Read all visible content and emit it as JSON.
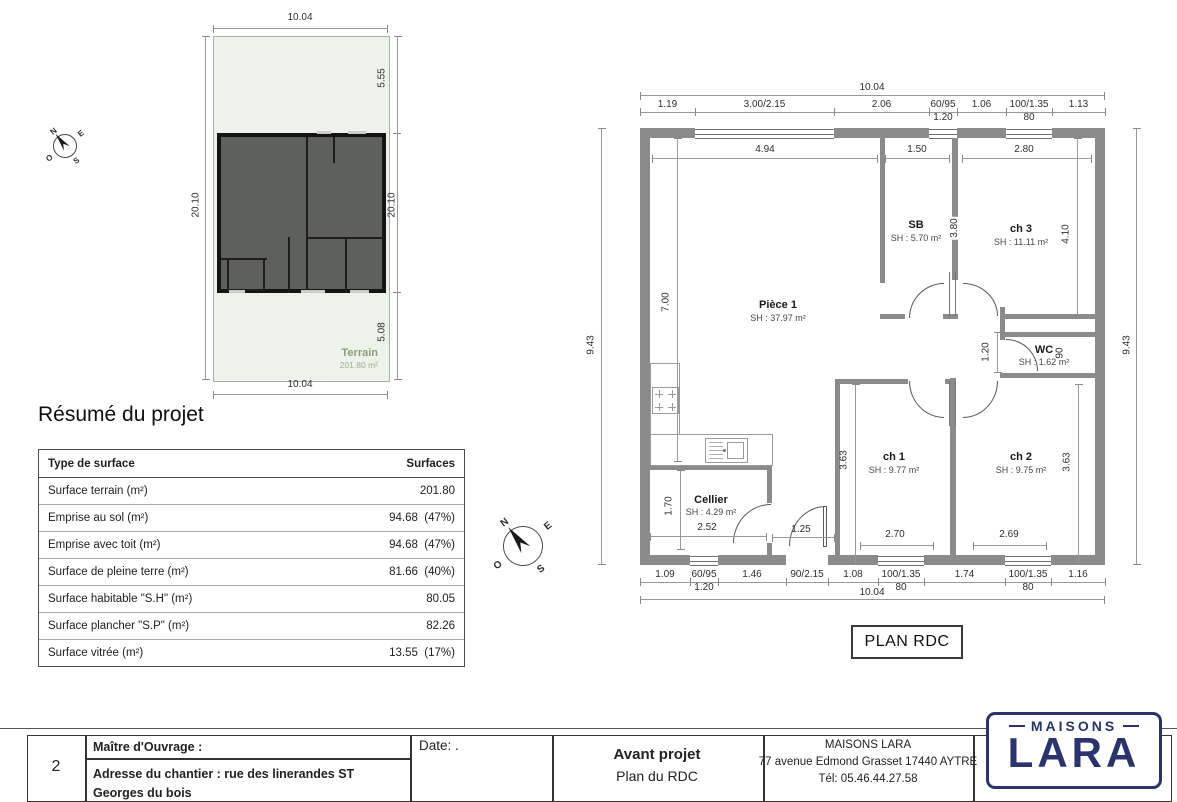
{
  "colors": {
    "wall_gray": "#8b8b8b",
    "terrain_fill": "#edf2eb",
    "terrain_text_green": "#87a176",
    "building_fill": "#5e605c",
    "logo_navy": "#29336e"
  },
  "compass": {
    "n": "N",
    "e": "E",
    "s": "S",
    "o": "O"
  },
  "site_plan": {
    "dim_width_top": "10.04",
    "dim_width_bottom": "10.04",
    "dim_depth_left": "20.10",
    "dim_depth_right": "20.10",
    "dim_front": "5.55",
    "dim_rear": "5.08",
    "terrain_label": "Terrain",
    "terrain_area": "201.80 m²"
  },
  "summary": {
    "title": "Résumé du projet",
    "col_type": "Type de surface",
    "col_value": "Surfaces",
    "rows": [
      {
        "label": "Surface terrain (m²)",
        "value": "201.80"
      },
      {
        "label": "Emprise au sol (m²)",
        "value": "94.68  (47%)"
      },
      {
        "label": "Emprise avec toit (m²)",
        "value": "94.68  (47%)"
      },
      {
        "label": "Surface de pleine terre (m²)",
        "value": "81.66  (40%)"
      },
      {
        "label": "Surface habitable \"S.H\" (m²)",
        "value": "80.05"
      },
      {
        "label": "Surface plancher \"S.P\" (m²)",
        "value": "82.26"
      },
      {
        "label": "Surface vitrée (m²)",
        "value": "13.55  (17%)"
      }
    ]
  },
  "floor_plan": {
    "caption": "PLAN RDC",
    "dim_overall_top": "10.04",
    "dim_overall_bottom": "10.04",
    "dim_height_left": "9.43",
    "dim_height_right": "9.43",
    "top_chain": [
      "1.19",
      "3.00/2.15",
      "2.06",
      "60/95",
      "1.06",
      "100/1.35",
      "1.13"
    ],
    "top_chain_sub": [
      "",
      "",
      "",
      "1.20",
      "",
      "80",
      ""
    ],
    "bottom_chain": [
      "1.09",
      "60/95",
      "1.46",
      "90/2.15",
      "1.08",
      "100/1.35",
      "1.74",
      "100/1.35",
      "1.16"
    ],
    "bottom_chain_sub": [
      "",
      "1.20",
      "",
      "",
      "",
      "80",
      "",
      "80",
      ""
    ],
    "rooms": {
      "piece1": {
        "name": "Pièce 1",
        "area": "SH : 37.97 m²"
      },
      "sb": {
        "name": "SB",
        "area": "SH : 5.70 m²"
      },
      "ch3": {
        "name": "ch 3",
        "area": "SH : 11.11 m²"
      },
      "wc": {
        "name": "WC",
        "area": "SH : 1.62 m²"
      },
      "ch1": {
        "name": "ch 1",
        "area": "SH : 9.77 m²"
      },
      "ch2": {
        "name": "ch 2",
        "area": "SH : 9.75 m²"
      },
      "cellier": {
        "name": "Cellier",
        "area": "SH : 4.29 m²"
      }
    },
    "interior_dims": {
      "piece1_width": "4.94",
      "sb_width": "1.50",
      "ch3_width": "2.80",
      "piece1_height": "7.00",
      "sb_height": "3.80",
      "ch3_height": "4.10",
      "hall_width": "1.20",
      "wc_door": "90",
      "ch1_height": "3.63",
      "ch2_height": "3.63",
      "cellier_height": "1.70",
      "cellier_width": "2.52",
      "hall_passage": "1.25",
      "ch1_window": "2.70",
      "ch2_window": "2.69"
    }
  },
  "title_block": {
    "page_number": "2",
    "owner_label": "Maître d'Ouvrage :",
    "address_line": "Adresse du chantier : rue des linerandes ST Georges du bois",
    "date_label": "Date: .",
    "doc_title": "Avant projet",
    "doc_subtitle": "Plan du RDC",
    "company_name": "MAISONS LARA",
    "company_address": "77 avenue Edmond Grasset 17440 AYTRE",
    "company_phone": "Tél: 05.46.44.27.58",
    "logo_top": "MAISONS",
    "logo_main": "LARA"
  }
}
